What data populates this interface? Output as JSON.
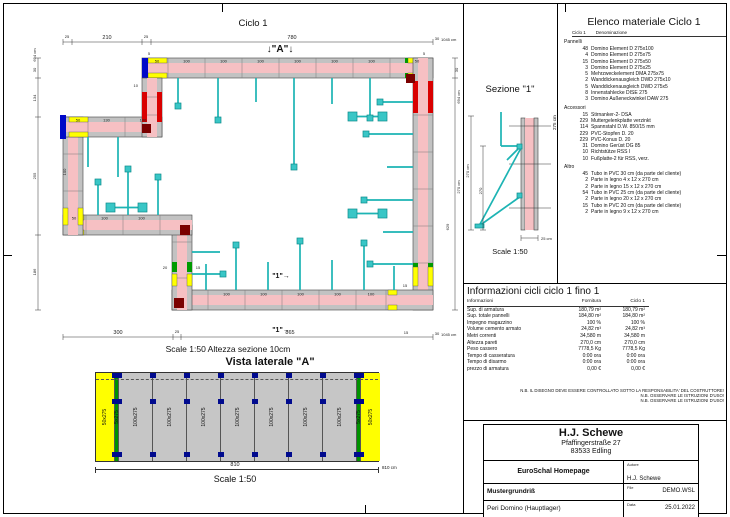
{
  "plan": {
    "title": "Ciclo 1",
    "marker_a": "↓\"A\"↓",
    "section_marker": "\"1\"→",
    "scale_note": "Scale 1:50   Altezza sezione 10cm",
    "lbl": {
      "l5": "5",
      "l10": "10",
      "l15": "15",
      "l20": "20",
      "l25": "25",
      "l30": "30",
      "l50": "50",
      "l100": "100",
      "l130": "130",
      "l210": "210",
      "l300": "300",
      "l780": "780",
      "l865": "865",
      "l134": "134",
      "l255": "255",
      "l186": "186",
      "l270cm": "270 cm",
      "l629": "629",
      "l694cm": "694 cm",
      "total": "1045 cm"
    },
    "colors": {
      "wall": "#f6c0c3",
      "panel": "#c2c2c2",
      "element50": "#ffff00",
      "endpiece": "#0008c8",
      "corner": "#7b0000",
      "compensation": "#009b00",
      "accessory": "#1db4b4"
    }
  },
  "sezione": {
    "title": "Sezione \"1\"",
    "dim_outer": "270 cm",
    "dim_inner": "270",
    "dim_wall": "25 cm",
    "scale": "Scale 1:50"
  },
  "materials": {
    "title": "Elenco materiale  Ciclo 1",
    "col_qty": "Ciclo 1",
    "col_name": "Denominazione",
    "side_label": "275 cm",
    "groups": [
      {
        "name": "Pannelli",
        "items": [
          [
            "48",
            "Domino Element D 275x100"
          ],
          [
            "4",
            "Domino Element D 275x75"
          ],
          [
            "15",
            "Domino Element D 275x50"
          ],
          [
            "3",
            "Domino Element D 275x25"
          ],
          [
            "5",
            "Mehrzweckelement DMA 275x75"
          ],
          [
            "2",
            "Wanddickenausgleich DWD 275x10"
          ],
          [
            "5",
            "Wanddickenausgleich DWD 275x5"
          ],
          [
            "8",
            "Innenstahlecke DISE 275"
          ],
          [
            "3",
            "Domino Außeneckwinkel DAW 275"
          ]
        ]
      },
      {
        "name": "Accessori",
        "items": [
          [
            "15",
            "Stirnanker-2- DSA"
          ],
          [
            "229",
            "Muttergelenkplatte verzinkt"
          ],
          [
            "114",
            "Spannstahl D.W. 850/15 mm"
          ],
          [
            "229",
            "PVC-Stopfen D. 20"
          ],
          [
            "229",
            "PVC-Konus D. 20"
          ],
          [
            "31",
            "Domino Gerüst DG 85"
          ],
          [
            "10",
            "Richtstütze RSS I"
          ],
          [
            "10",
            "Fußplatte-2 für RSS, verz."
          ]
        ]
      },
      {
        "name": "Altro",
        "items": [
          [
            "45",
            "Tubo in PVC 30 cm (da parte del cliente)"
          ],
          [
            "2",
            "Parte in legno 4 x 12 x 270 cm"
          ],
          [
            "2",
            "Parte in legno 15 x 12 x 270 cm"
          ],
          [
            "54",
            "Tubo in PVC 25 cm (da parte del cliente)"
          ],
          [
            "2",
            "Parte in legno 20 x 12 x 270 cm"
          ],
          [
            "15",
            "Tubo in PVC 20 cm (da parte del cliente)"
          ],
          [
            "2",
            "Parte in legno 9 x 12 x 270 cm"
          ]
        ]
      }
    ]
  },
  "info": {
    "title": "Informazioni cicli  ciclo 1 fino 1",
    "headers": [
      "Informazioni",
      "Fornitura",
      "Ciclo 1"
    ],
    "rows": [
      [
        "Sup. di armatura",
        "180,79 m²",
        "180,79 m²"
      ],
      [
        "Sup. totale pannelli",
        "184,80 m²",
        "184,80 m²"
      ],
      [
        "Impegno magazzino",
        "100 %",
        "100 %"
      ],
      [
        "Volume cemento armato",
        "24,82 m³",
        "24,82 m³"
      ],
      [
        "Metri correnti",
        "34,580 m",
        "34,580 m"
      ],
      [
        "Altezza pareti",
        "270,0 cm",
        "270,0 cm"
      ],
      [
        "Peso cassero",
        "7778,5 Kg",
        "7778,5 Kg"
      ],
      [
        "Tempo di casseratura",
        "0:00 ora",
        "0:00 ora"
      ],
      [
        "Tempo di disarmo",
        "0:00 ora",
        "0:00 ora"
      ],
      [
        "prezzo di armatura",
        "0,00 €",
        "0,00 €"
      ]
    ]
  },
  "notes": [
    "N.B. IL DISEGNO DEVE ESSERE CONTROLLATO SOTTO LA RESPONSABILITA' DEL COSTRUTTORE!",
    "N.B. OSSERVARE LE ISTRUZIONI D'USO!",
    "N.B. OSSERVARE LE ISTRUZIONI D'USO!"
  ],
  "lateral": {
    "title": "Vista laterale \"A\"",
    "dim": "810",
    "dim_total": "810 cm",
    "scale": "Scale 1:50",
    "panels": [
      {
        "cls": "p-yel",
        "label": "50x275"
      },
      {
        "cls": "p-grn has-clamps",
        "label": "5x275"
      },
      {
        "cls": "p-gray has-clamps",
        "label": "100x275"
      },
      {
        "cls": "p-gray has-clamps",
        "label": "100x275"
      },
      {
        "cls": "p-gray has-clamps",
        "label": "100x275"
      },
      {
        "cls": "p-gray has-clamps",
        "label": "100x275"
      },
      {
        "cls": "p-gray has-clamps",
        "label": "100x275"
      },
      {
        "cls": "p-gray has-clamps",
        "label": "100x275"
      },
      {
        "cls": "p-gray has-clamps",
        "label": "100x275"
      },
      {
        "cls": "p-grn has-clamps",
        "label": "5x275"
      },
      {
        "cls": "p-yel has-clamps",
        "label": "50x275"
      }
    ]
  },
  "titleblock": {
    "company": "H.J. Schewe",
    "street": "Pfaffingerstraße 27",
    "city": "83533 Edling",
    "client_value": "EuroSchal Homepage",
    "author_label": "Autore",
    "author_value": "H.J. Schewe",
    "project_value": "Mustergrundriß",
    "file_label": "File",
    "file_value": "DEMO.WSL",
    "site_value": "Peri Domino (Hauptlager)",
    "date_label": "Data",
    "date_value": "25.01.2022"
  }
}
